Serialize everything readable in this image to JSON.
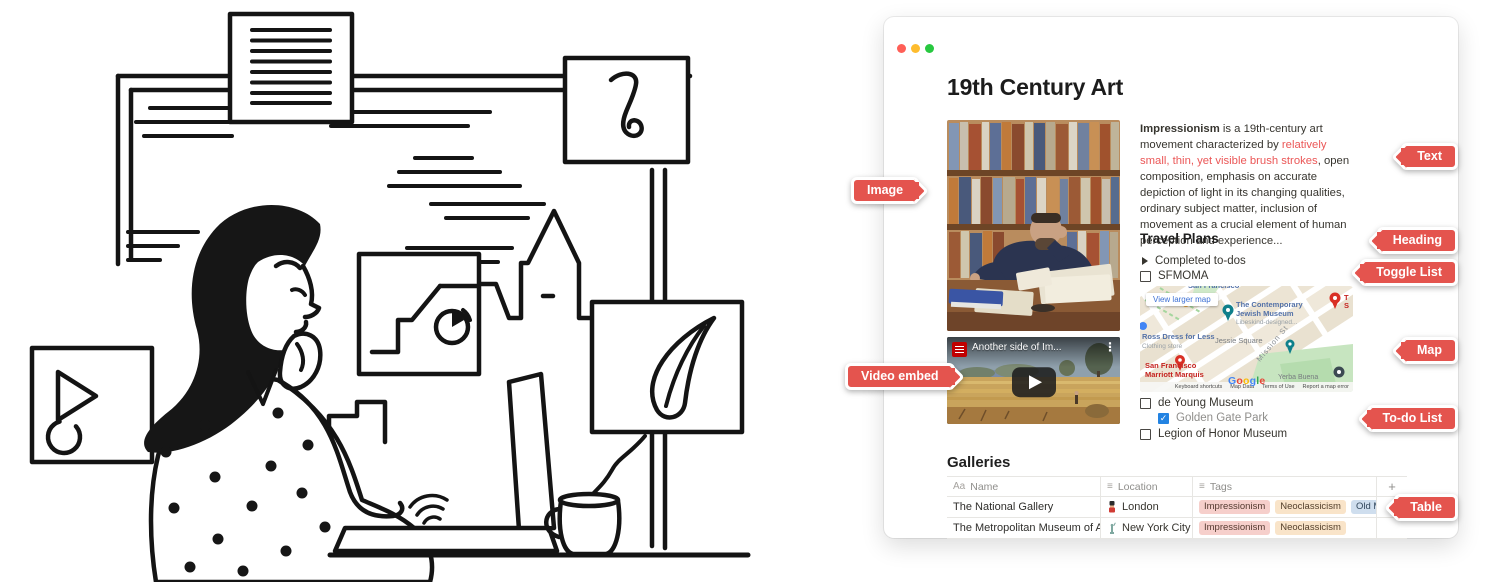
{
  "window": {
    "title": "19th Century Art",
    "intro": {
      "lead": "Impressionism",
      "mid": " is a 19th-century art movement characterized by ",
      "highlight": "relatively small, thin, yet visible brush strokes",
      "rest": ", open composition, emphasis on accurate depiction of light in its changing qualities, ordinary subject matter, inclusion of movement as a crucial element of human perception and experience..."
    },
    "travel": {
      "heading": "Travel Plans",
      "toggle_label": "Completed to-dos"
    },
    "todos": [
      {
        "label": "SFMOMA",
        "checked": false
      },
      {
        "label": "de Young Museum",
        "checked": false
      },
      {
        "label": "Golden Gate Park",
        "checked": true
      },
      {
        "label": "Legion of Honor Museum",
        "checked": false
      }
    ],
    "video": {
      "title": "Another side of Im...",
      "menu_icon": "⋮"
    },
    "map": {
      "view_larger": "View larger map",
      "top_clipped_label": "San Francisco",
      "museum": "The Contemporary Jewish Museum",
      "museum_sub": "Libeskind-designed...",
      "store": "Ross Dress for Less",
      "store_sub": "Clothing store",
      "square": "Jessie Square",
      "street": "Mission St",
      "hotel_line1": "San Francisco",
      "hotel_line2": "Marriott Marquis",
      "park": "Yerba Buena",
      "right_clipped_1": "T",
      "right_clipped_2": "S",
      "google_letters": [
        "G",
        "o",
        "o",
        "g",
        "l",
        "e"
      ],
      "attribution": [
        "Keyboard shortcuts",
        "Map Data",
        "Terms of Use",
        "Report a map error"
      ]
    },
    "galleries": {
      "heading": "Galleries",
      "columns": [
        {
          "icon": "Aa",
          "label": "Name"
        },
        {
          "icon": "≡",
          "label": "Location"
        },
        {
          "icon": "≡",
          "label": "Tags"
        }
      ],
      "add_column": "+",
      "rows": [
        {
          "name": "The National Gallery",
          "location": "London",
          "tags": [
            {
              "label": "Impressionism",
              "color": "pink"
            },
            {
              "label": "Neoclassicism",
              "color": "tan"
            },
            {
              "label": "Old Masters",
              "color": "blue"
            }
          ]
        },
        {
          "name": "The Metropolitan Museum of Art",
          "location": "New York City",
          "tags": [
            {
              "label": "Impressionism",
              "color": "pink"
            },
            {
              "label": "Neoclassicism",
              "color": "tan"
            }
          ]
        }
      ]
    }
  },
  "badges": {
    "image": "Image",
    "video": "Video embed",
    "text": "Text",
    "heading": "Heading",
    "toggle": "Toggle List",
    "map": "Map",
    "todo": "To-do List",
    "table": "Table"
  },
  "glyphs": {
    "check": "✓"
  },
  "colors": {
    "badge_red": "#e4544e",
    "notion_red_text": "#eb5757",
    "checkbox_blue": "#2383e2",
    "tag_pink_bg": "#f6cfcb",
    "tag_tan_bg": "#f9e4c9",
    "tag_blue_bg": "#cfdeee",
    "traffic_close": "#ff5f57",
    "traffic_minimize": "#febc2e",
    "traffic_zoom": "#28c840",
    "google_letter_colors": [
      "#4285F4",
      "#EA4335",
      "#FBBC05",
      "#4285F4",
      "#34A853",
      "#EA4335"
    ]
  }
}
